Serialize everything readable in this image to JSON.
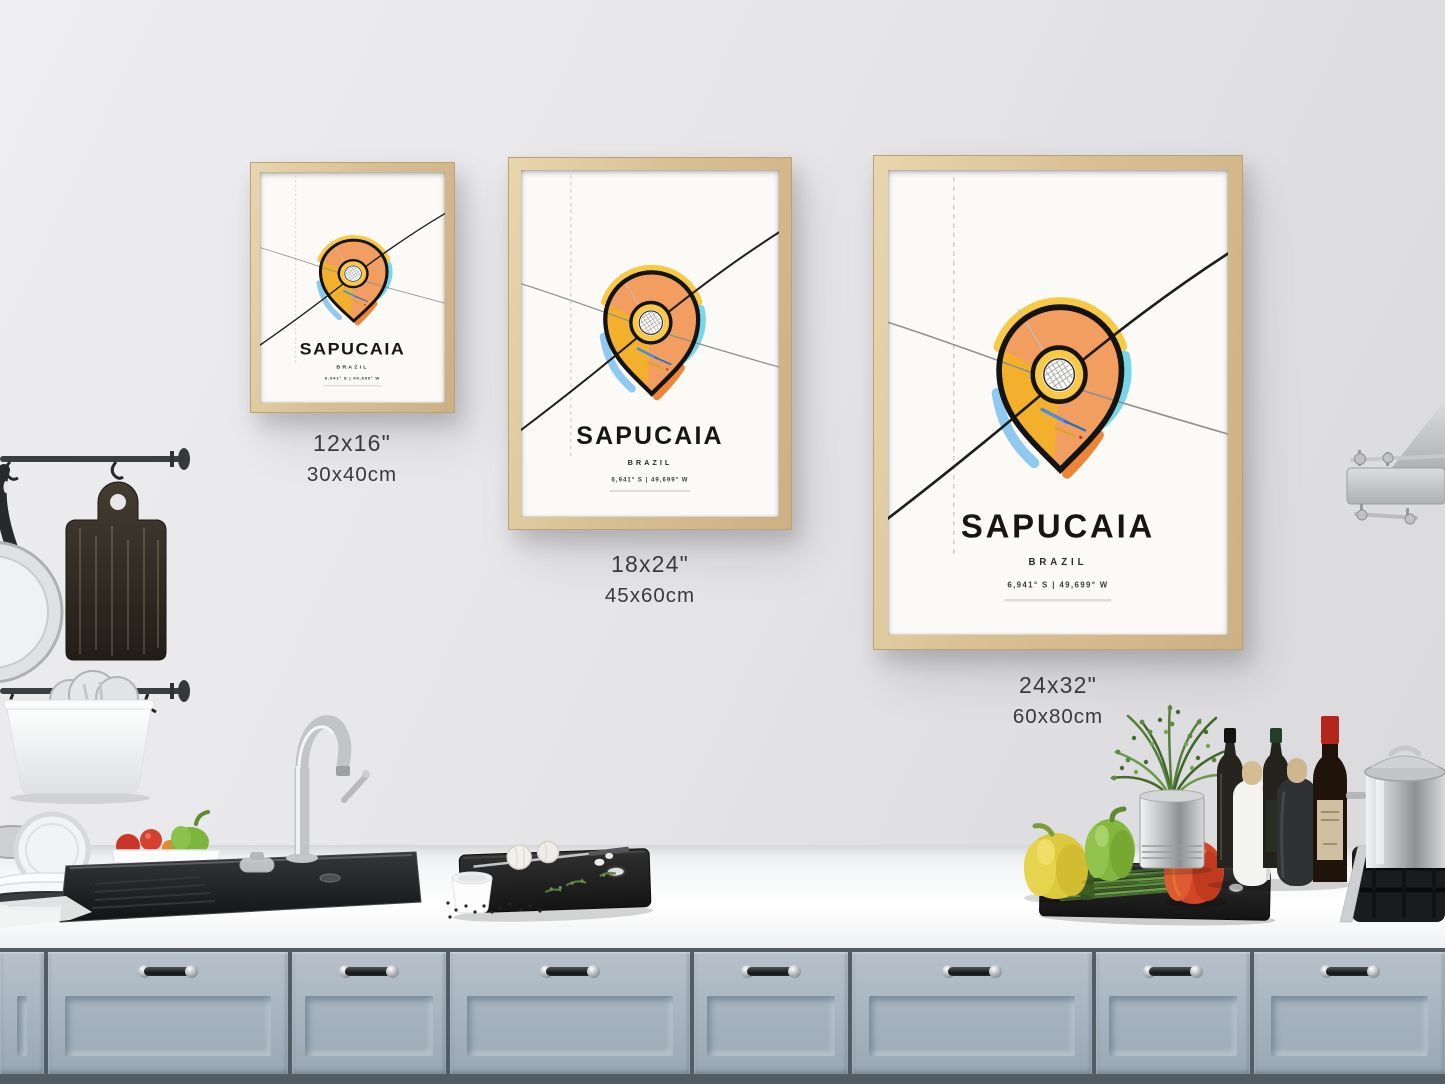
{
  "poster": {
    "title": "SAPUCAIA",
    "country": "BRAZIL",
    "coordinates": "6,941° S | 49,699° W"
  },
  "size_labels": [
    {
      "inches": "12x16\"",
      "cm": "30x40cm"
    },
    {
      "inches": "18x24\"",
      "cm": "45x60cm"
    },
    {
      "inches": "24x32\"",
      "cm": "60x80cm"
    }
  ],
  "colors": {
    "pin_orange": "#f19e60",
    "pin_yellow": "#f2b02c",
    "fringe_yellow": "#f8c947",
    "fringe_cyan": "#77d7e6",
    "fringe_blue": "#90c9ef",
    "fringe_orange": "#ee8435",
    "outline_black": "#141414",
    "frame_wood": "#d9c093",
    "wall": "#e6e6e8",
    "cabinet_blue": "#a8b5c1"
  }
}
